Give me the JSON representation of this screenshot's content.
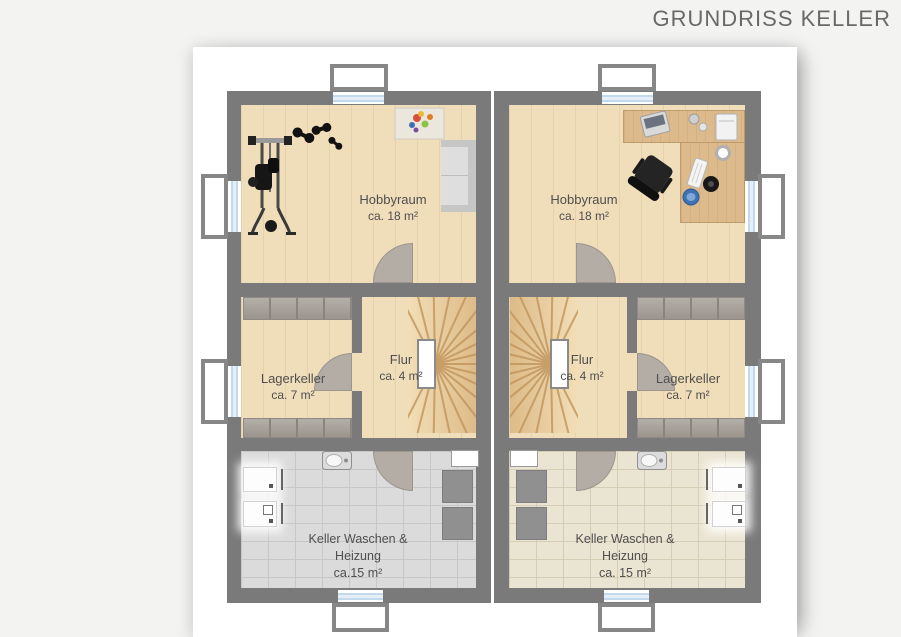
{
  "header": {
    "title": "GRUNDRISS KELLER"
  },
  "units": {
    "left": {
      "hobbyraum": {
        "name": "Hobbyraum",
        "area": "ca. 18 m²"
      },
      "lagerkeller": {
        "name": "Lagerkeller",
        "area": "ca. 7 m²"
      },
      "flur": {
        "name": "Flur",
        "area": "ca. 4 m²"
      },
      "laundry": {
        "line1": "Keller Waschen &",
        "line2": "Heizung",
        "line3": "ca.15 m²"
      }
    },
    "right": {
      "hobbyraum": {
        "name": "Hobbyraum",
        "area": "ca. 18 m²"
      },
      "lagerkeller": {
        "name": "Lagerkeller",
        "area": "ca. 7 m²"
      },
      "flur": {
        "name": "Flur",
        "area": "ca. 4 m²"
      },
      "laundry": {
        "line1": "Keller Waschen &",
        "line2": "Heizung",
        "line3": "ca. 15 m²"
      }
    }
  },
  "colors": {
    "wall": "#7a7a7a",
    "wood_floor": "#f0ddb9",
    "desk_wood": "#dcba8c",
    "tile_left": "#dbdbdb",
    "tile_right": "#eae4d2",
    "window_blue": "#c3d9ee",
    "door_arc": "#b3ada6",
    "label_text": "#4f4f4f"
  }
}
